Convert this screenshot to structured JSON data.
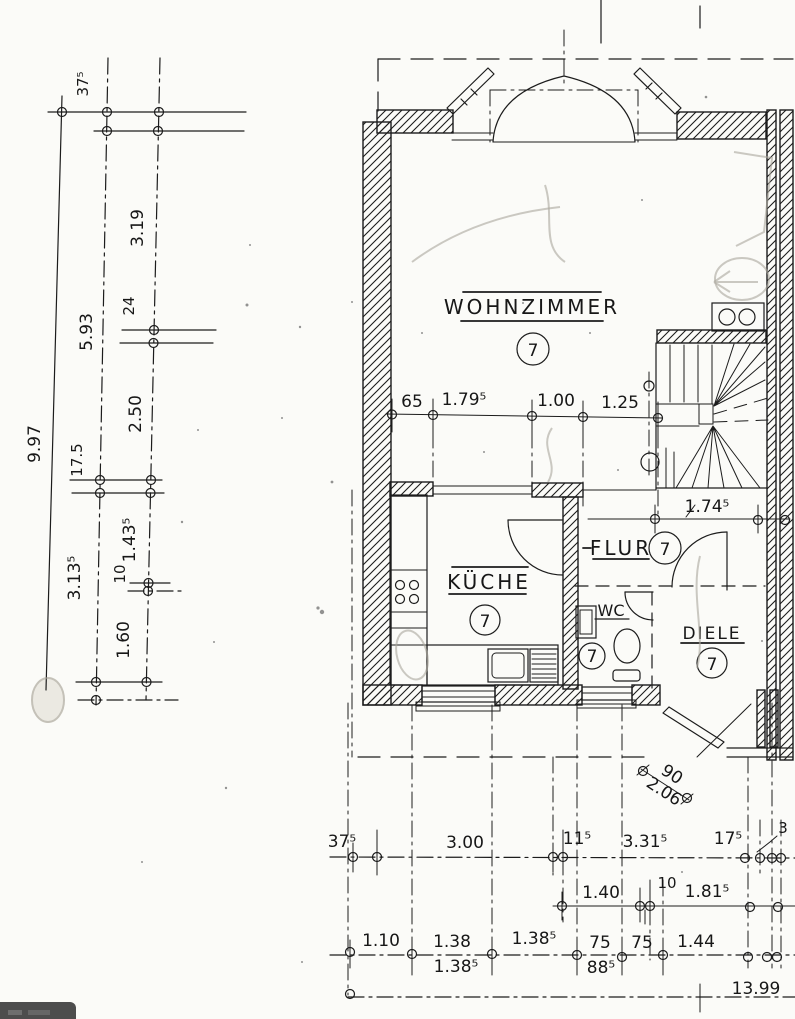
{
  "document": {
    "type": "scanned architectural floor plan",
    "language": "de"
  },
  "colors": {
    "ink": "#1c1c1c",
    "paper": "#fbfbf8",
    "pencil": "#aaa69c",
    "watermark_bg": "#4d4d4d"
  },
  "rooms": {
    "wohnzimmer": {
      "label": "WOHNZIMMER",
      "number": "7"
    },
    "kueche": {
      "label": "KÜCHE",
      "number": "7"
    },
    "flur": {
      "label": "FLUR",
      "number": "7"
    },
    "wc": {
      "label": "WC",
      "number": "7"
    },
    "diele": {
      "label": "DIELE",
      "number": "7"
    }
  },
  "left_chain": {
    "labels": [
      "37⁵",
      "3.19",
      "24",
      "5.93",
      "9.97",
      "2.50",
      "17.5",
      "1.43⁵",
      "3.13⁵",
      "10",
      "1.60"
    ]
  },
  "interior_dims": {
    "labels": [
      "65",
      "1.79⁵",
      "1.00",
      "1.25"
    ]
  },
  "flur_dim": "1.74⁵",
  "entrance_dim": {
    "width": "90",
    "depth": "2.06"
  },
  "bottom_rows": {
    "row1": [
      "37⁵",
      "3.00",
      "11⁵",
      "3.31⁵",
      "17⁵",
      "3"
    ],
    "row2": [
      "1.40",
      "10",
      "1.81⁵"
    ],
    "row3": [
      "1.10",
      "1.38",
      "1.38⁵",
      "75",
      "75",
      "1.44"
    ],
    "row3b": [
      "1.38⁵",
      "88⁵"
    ],
    "total": "13.99"
  }
}
